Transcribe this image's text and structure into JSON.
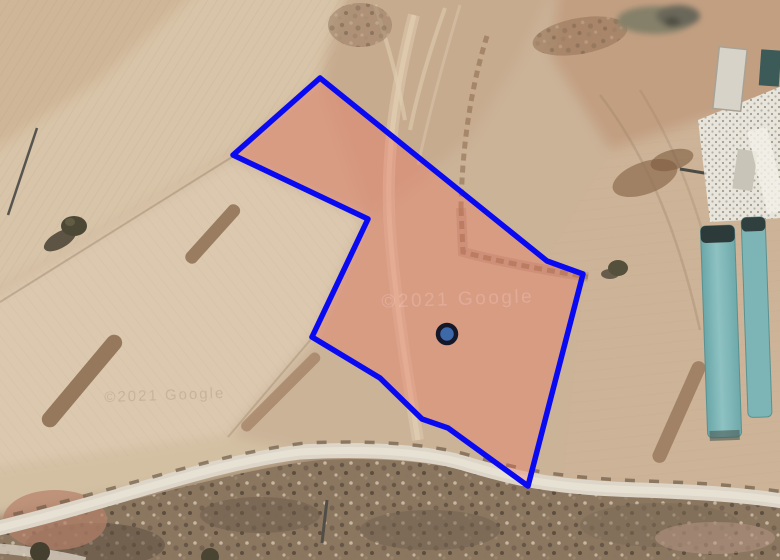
{
  "map": {
    "view_type": "satellite-imagery",
    "attribution": "©2021 Google",
    "parcel": {
      "points": "320,78 547,261 583,274 528,486 448,428 422,419 380,378 312,337 368,219 233,155",
      "stroke": "#0a0af2",
      "stroke_width": 5.5,
      "fill": "#f0705c",
      "fill_opacity": 0.34
    },
    "marker": {
      "cx": 447,
      "cy": 334,
      "r": 9,
      "fill": "#3d69a8",
      "ring": "#141828",
      "ring_width": 4.5
    }
  }
}
